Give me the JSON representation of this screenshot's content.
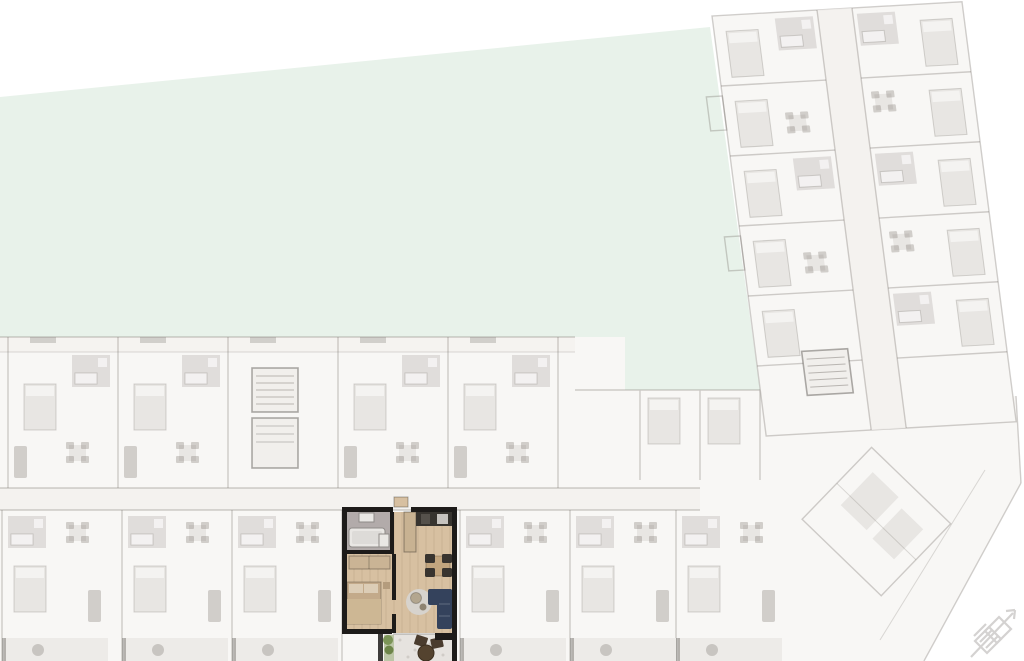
{
  "page": {
    "title": "Residential floor plan with highlighted apartment",
    "view": "site-plan"
  },
  "colors": {
    "background": "#ffffff",
    "garden": "#e8f2ea",
    "faded_building_fill": "#f8f7f5",
    "corridor": "#f2f0ed",
    "highlight_wall": "#1d1b19",
    "highlight_wood_floor": "#d7c0a1",
    "bathroom_floor": "#b2abaa",
    "bed": "#c3aa8a",
    "wardrobe": "#cab495",
    "sofa": "#34425c",
    "dining_table": "#c2a57e",
    "chair": "#38342f",
    "kitchen_counter": "#37342f",
    "kitchen_cabinet": "#c8b292",
    "rug": "#d7d3cd",
    "terrace_floor": "#e6e3df",
    "plant": "#7b9457",
    "outdoor_table": "#54432f",
    "compass": "#cdcbc9"
  },
  "highlighted_unit": {
    "rooms": [
      "bathroom",
      "bedroom",
      "kitchen",
      "living-dining",
      "terrace"
    ]
  },
  "sections": {
    "garden": "garden-area",
    "lower_wing": "lower-building-wing",
    "right_wing": "right-building-wing",
    "corner": "corner-building-section"
  },
  "icons": {
    "north_arrow": "north-arrow-icon"
  }
}
